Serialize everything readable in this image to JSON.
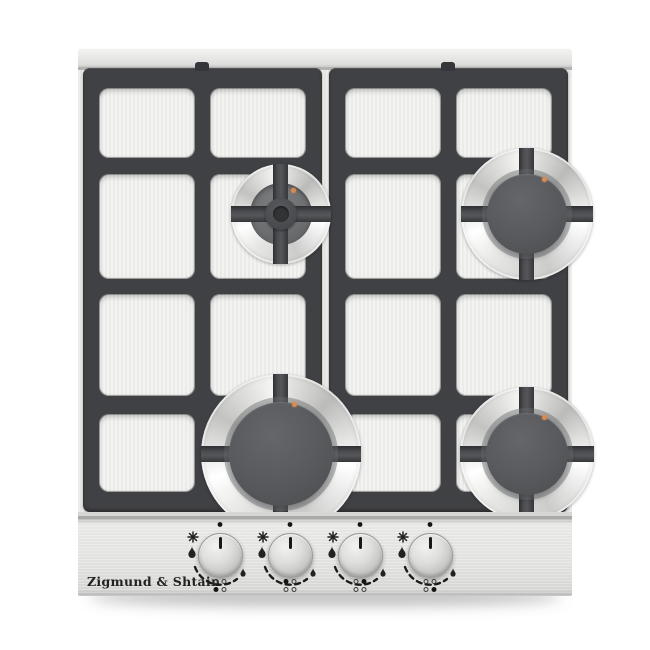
{
  "product": {
    "brand_logo_text": "Zigmund & Shtain"
  },
  "cooktop": {
    "grate_count": 2,
    "burners": [
      {
        "id": "rear-left",
        "size": "auxiliary",
        "grate_style": "cross-over-hub",
        "igniter_dot": true
      },
      {
        "id": "rear-right",
        "size": "semi-rapid",
        "grate_style": "four-fingers",
        "igniter_dot": true
      },
      {
        "id": "front-left",
        "size": "rapid",
        "grate_style": "four-fingers",
        "igniter_dot": true
      },
      {
        "id": "front-right",
        "size": "semi-rapid",
        "grate_style": "four-fingers",
        "igniter_dot": true
      }
    ]
  },
  "panel": {
    "brand_logo_text": "Zigmund & Shtain",
    "knobs": [
      {
        "id": "knob-1",
        "controls_burner": "front-left",
        "position": "off",
        "indicator_dots": {
          "top_left": false,
          "top_right": false,
          "bottom_left": true,
          "bottom_right": false
        },
        "markings": [
          "power-off-dot",
          "ignition-spark-icon",
          "high-flame-icon",
          "flame-range-arc",
          "low-flame-icon"
        ]
      },
      {
        "id": "knob-2",
        "controls_burner": "rear-left",
        "position": "off",
        "indicator_dots": {
          "top_left": true,
          "top_right": false,
          "bottom_left": false,
          "bottom_right": false
        },
        "markings": [
          "power-off-dot",
          "ignition-spark-icon",
          "high-flame-icon",
          "flame-range-arc",
          "low-flame-icon"
        ]
      },
      {
        "id": "knob-3",
        "controls_burner": "rear-right",
        "position": "off",
        "indicator_dots": {
          "top_left": false,
          "top_right": true,
          "bottom_left": false,
          "bottom_right": false
        },
        "markings": [
          "power-off-dot",
          "ignition-spark-icon",
          "high-flame-icon",
          "flame-range-arc",
          "low-flame-icon"
        ]
      },
      {
        "id": "knob-4",
        "controls_burner": "front-right",
        "position": "off",
        "indicator_dots": {
          "top_left": false,
          "top_right": false,
          "bottom_left": false,
          "bottom_right": true
        },
        "markings": [
          "power-off-dot",
          "ignition-spark-icon",
          "high-flame-icon",
          "flame-range-arc",
          "low-flame-icon"
        ]
      }
    ]
  },
  "colors": {
    "steel_surface": "#e9e9e7",
    "grate_dark": "#404144",
    "burner_cap": "#57595c",
    "igniter_orange": "#d98a4f",
    "control_panel": "#e5e5e3",
    "background": "#ffffff"
  }
}
